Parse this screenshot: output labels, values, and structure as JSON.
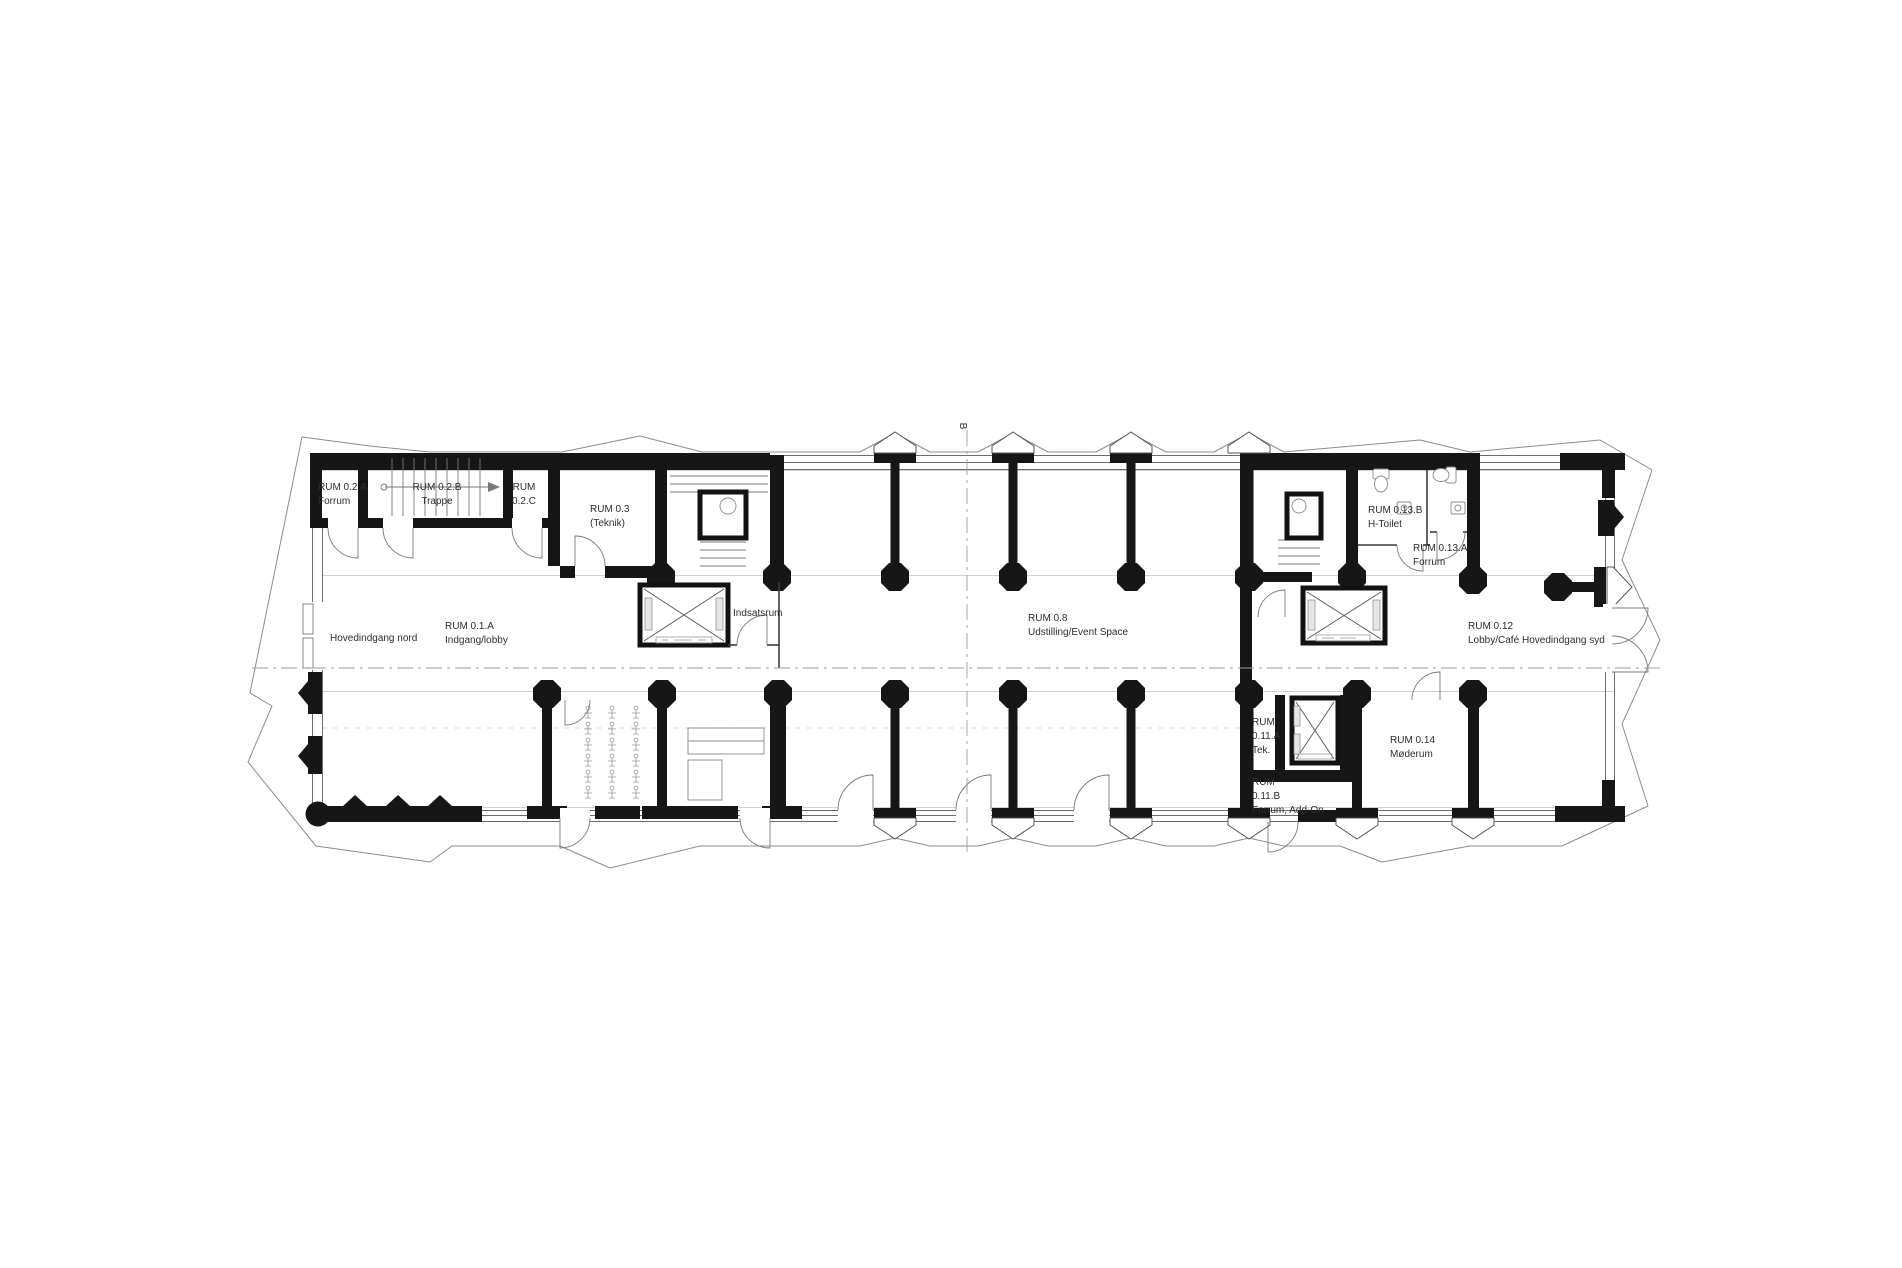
{
  "colors": {
    "background": "#ffffff",
    "wall": "#161616",
    "thin_line": "#6b6b6b",
    "light_line": "#c2c2c2",
    "text": "#2e2e2e"
  },
  "section_marker": {
    "label": "B"
  },
  "labels": {
    "r02a": [
      "RUM 0.2.A",
      "Forrum"
    ],
    "r02b": [
      "RUM 0.2.B",
      "Trappe"
    ],
    "r02c": [
      "RUM",
      "0.2.C"
    ],
    "r03": [
      "RUM 0.3",
      "(Teknik)"
    ],
    "hoved_nord": [
      "Hovedindgang nord"
    ],
    "r01a": [
      "RUM 0.1.A",
      "Indgang/lobby"
    ],
    "indsatsrum": [
      "Indsatsrum"
    ],
    "r08": [
      "RUM 0.8",
      "Udstilling/Event Space"
    ],
    "r013b": [
      "RUM 0.13.B",
      "H-Toilet"
    ],
    "r013a": [
      "RUM 0.13.A",
      "Forrum"
    ],
    "r012": [
      "RUM 0.12",
      "Lobby/Café"
    ],
    "hoved_syd": [
      "Hovedindgang syd"
    ],
    "r011a": [
      "RUM",
      "0.11.A",
      "Tek."
    ],
    "r014": [
      "RUM 0.14",
      "Møderum"
    ],
    "r011b": [
      "RUM",
      "0.11.B",
      "Forrum, Add-On"
    ]
  }
}
